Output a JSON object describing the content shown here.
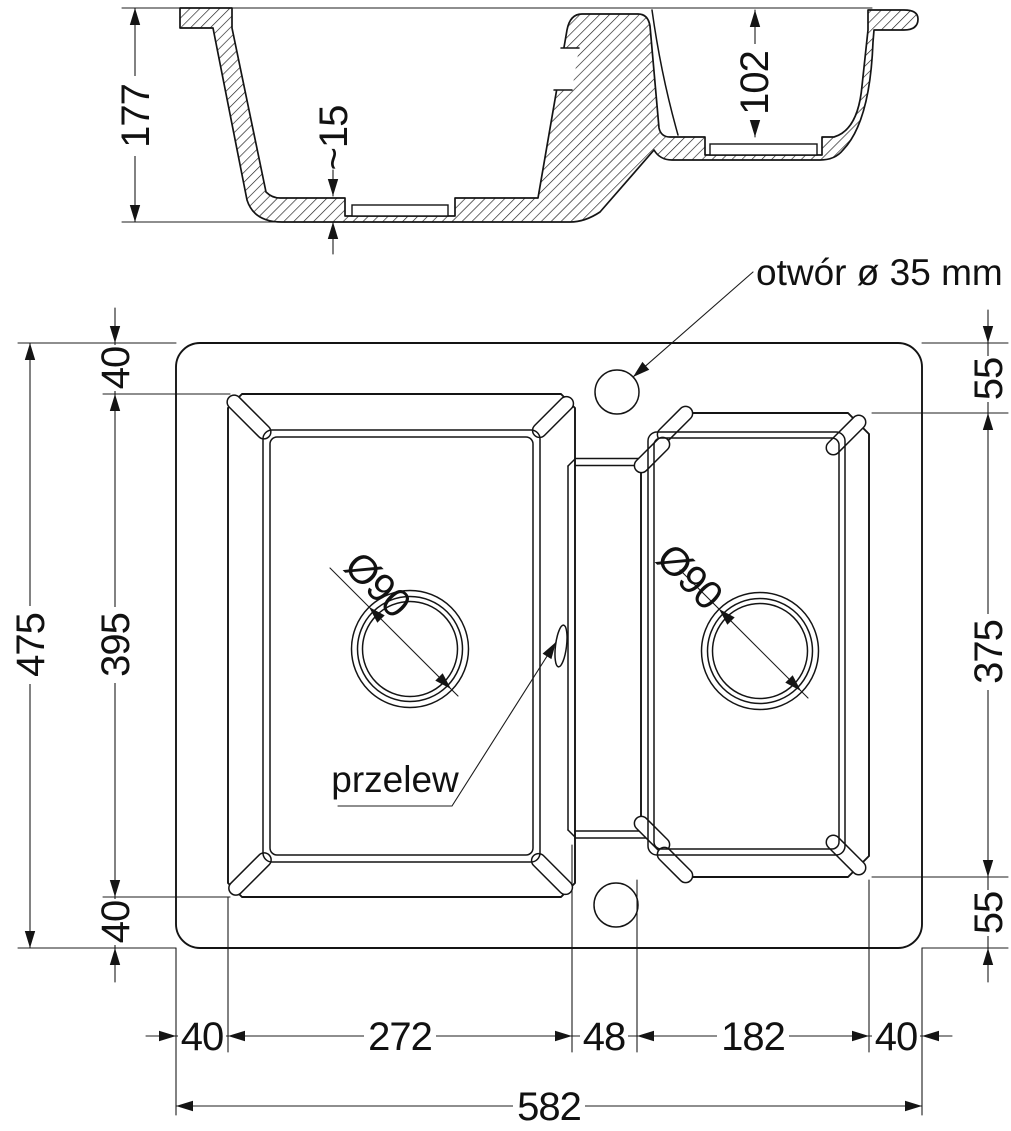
{
  "section": {
    "total_depth": "177",
    "drain_plate": "~15",
    "small_bowl_depth": "102"
  },
  "plan": {
    "tap_hole_note": "otwór ø 35 mm",
    "overflow_label": "przelew",
    "left_drain": "Ø90",
    "right_drain": "Ø90",
    "left_dims": {
      "total": "475",
      "top": "40",
      "bowl": "395",
      "bottom": "40"
    },
    "right_dims": {
      "top": "55",
      "bowl": "375",
      "bottom": "55"
    },
    "bottom_dims": {
      "row": [
        "40",
        "272",
        "48",
        "182",
        "40"
      ],
      "total": "582"
    }
  }
}
